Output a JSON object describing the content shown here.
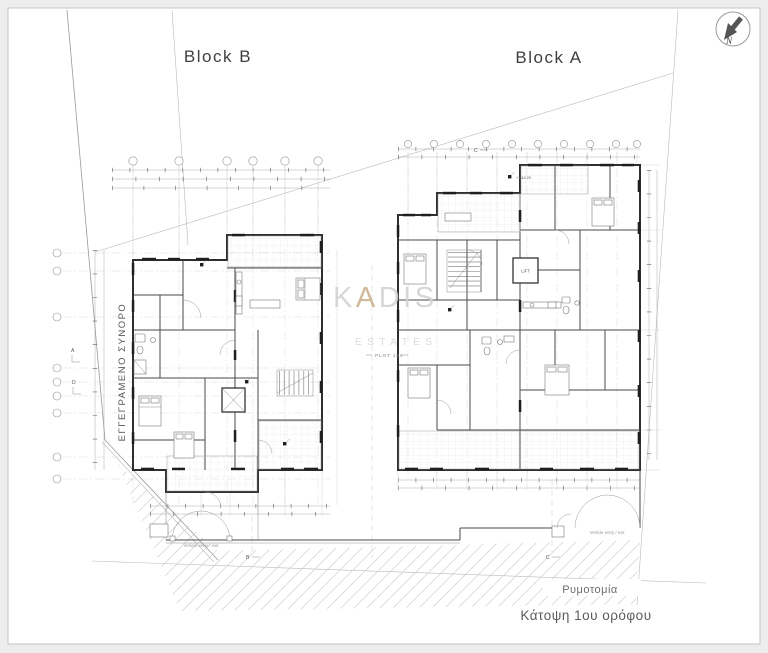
{
  "title_labels": {
    "block_b": "Block B",
    "block_a": "Block A"
  },
  "north": {
    "letter": "N"
  },
  "watermark": {
    "k": "K",
    "a": "A",
    "dis": "DIS",
    "line2": "ESTATES"
  },
  "site": {
    "boundary_label": "ΕΓΓΕΓΡΑΜΕΝΟ ΣΥΝΟΡΟ",
    "plot_label": "PLOT 194",
    "road_label": "Ρυμοτομία",
    "caption": "Κάτοψη 1ου ορόφου"
  },
  "annotations": {
    "vehicle_entry_left": "Vehicle entry / exit",
    "vehicle_entry_right": "Vehicle entry / exit",
    "lift": "LIFT",
    "level_mark": "+1.44.20",
    "section_a": "A",
    "section_b": "B",
    "section_c_bottom": "C",
    "section_c_top": "C",
    "section_d": "D"
  },
  "colors": {
    "wall": "#2e2e2e",
    "boundary_gray": "#9a9a9a",
    "watermark_gray": "#d2d2d2",
    "watermark_gold": "#bfa276",
    "paper": "#ffffff",
    "margin": "#ededed"
  }
}
